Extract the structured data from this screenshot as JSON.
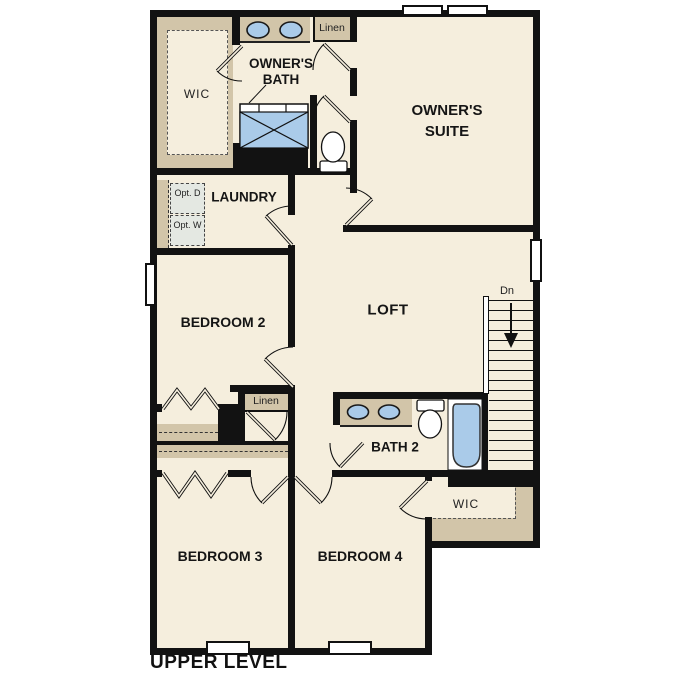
{
  "plan_title": "UPPER LEVEL",
  "rooms": {
    "wic_upper": {
      "label": "WIC"
    },
    "owners_bath": {
      "line1": "OWNER'S",
      "line2": "BATH"
    },
    "linen_upper": {
      "label": "Linen"
    },
    "owners_suite": {
      "line1": "OWNER'S",
      "line2": "SUITE"
    },
    "laundry": {
      "label": "LAUNDRY"
    },
    "opt_dryer": {
      "line1": "Opt.",
      "line2": "D"
    },
    "opt_washer": {
      "line1": "Opt.",
      "line2": "W"
    },
    "bedroom2": {
      "label": "BEDROOM 2"
    },
    "loft": {
      "label": "LOFT"
    },
    "linen_mid": {
      "label": "Linen"
    },
    "bath2": {
      "label": "BATH 2"
    },
    "bedroom3": {
      "label": "BEDROOM 3"
    },
    "bedroom4": {
      "label": "BEDROOM 4"
    },
    "wic_lower": {
      "label": "WIC"
    }
  },
  "stairs": {
    "label": "Dn",
    "direction": "down"
  },
  "colors": {
    "wall": "#121212",
    "floor": "#f5eedd",
    "casework_tan": "#d2c5a9",
    "fixture_blue": "#aacbe9",
    "optional_appliance": "#e4e8e2",
    "background": "#ffffff"
  }
}
